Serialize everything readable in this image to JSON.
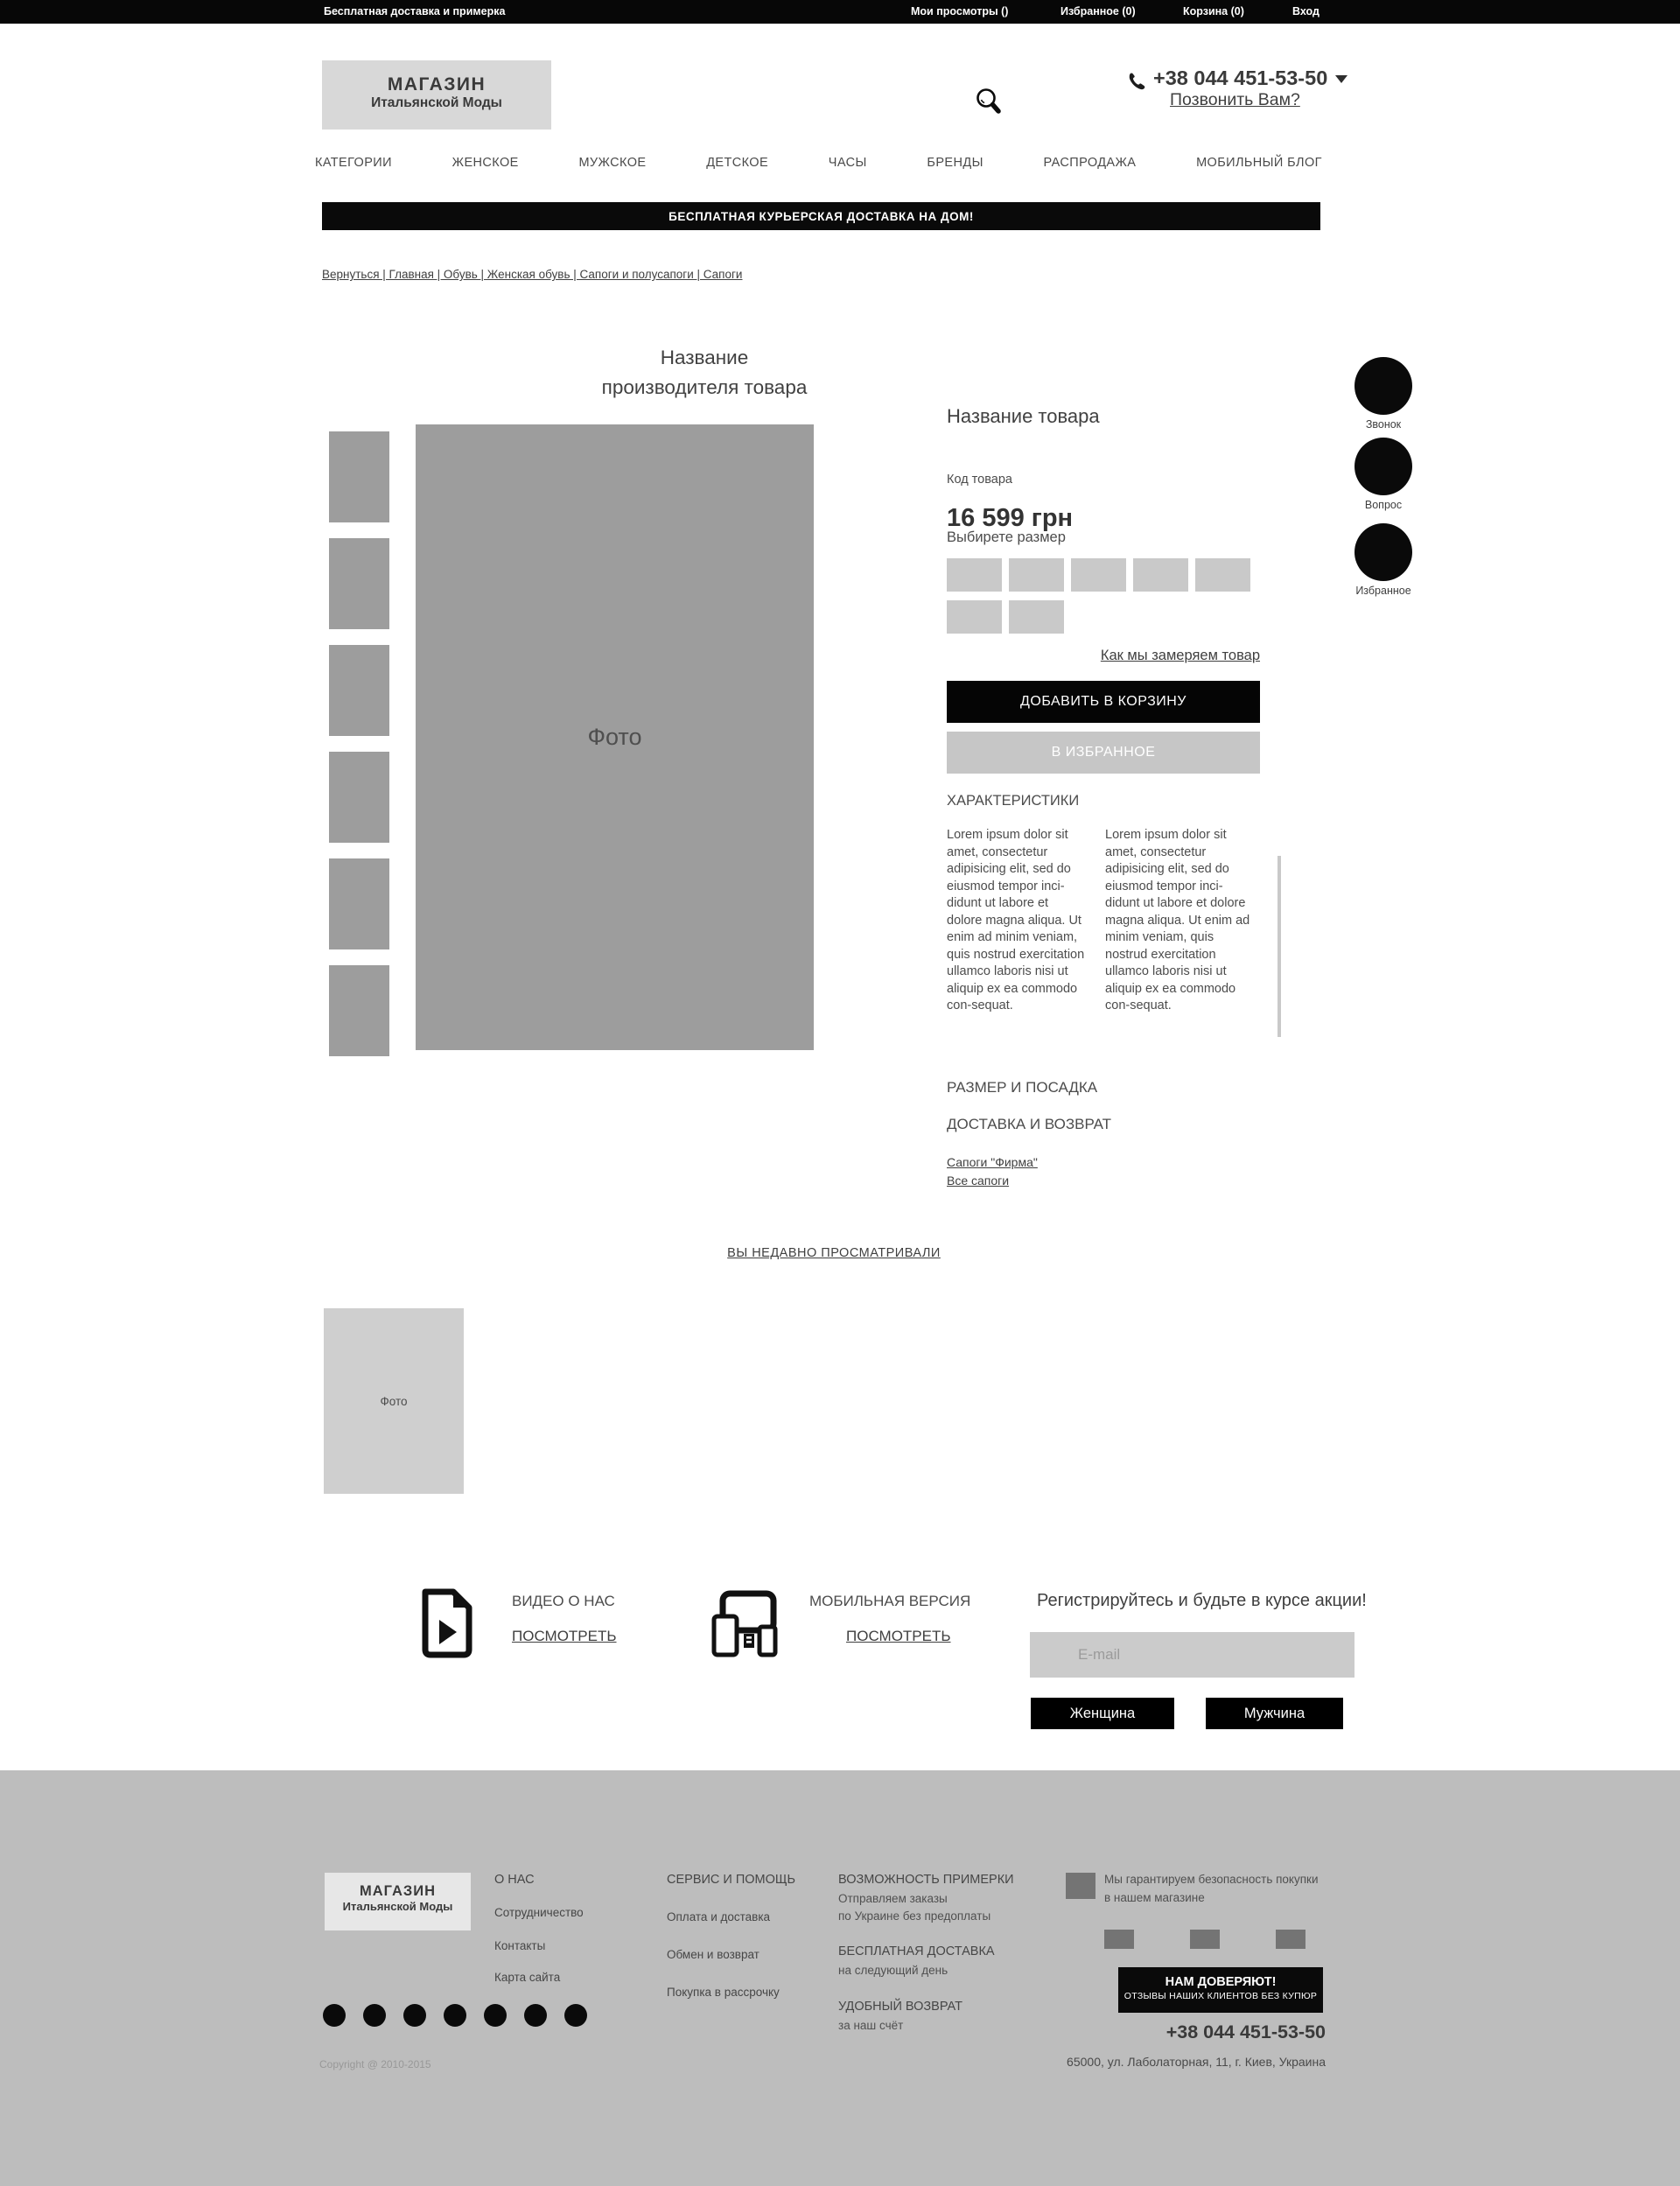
{
  "topbar": {
    "promo": "Бесплатная доставка и примерка",
    "views": "Мои просмотры ()",
    "favorites": "Избранное (0)",
    "cart": "Корзина (0)",
    "login": "Вход"
  },
  "header": {
    "logo_line1": "МАГАЗИН",
    "logo_line2": "Итальянской Моды",
    "phone": "+38 044 451-53-50",
    "call_link": "Позвонить Вам?"
  },
  "nav": {
    "items": [
      "КАТЕГОРИИ",
      "ЖЕНСКОЕ",
      "МУЖСКОЕ",
      "ДЕТСКОЕ",
      "ЧАСЫ",
      "БРЕНДЫ",
      "РАСПРОДАЖА",
      "МОБИЛЬНЫЙ БЛОГ"
    ]
  },
  "banner": "БЕСПЛАТНАЯ КУРЬЕРСКАЯ ДОСТАВКА НА ДОМ!",
  "breadcrumb": "Вернуться | Главная | Обувь | Женская  обувь | Сапоги и полусапоги | Сапоги",
  "product": {
    "brand_title": "Название производителя товара",
    "photo_label": "Фото",
    "name": "Название товара",
    "code_label": "Код товара",
    "price": "16 599 грн",
    "size_label": "Выбирете размер",
    "measure_link": "Как мы замеряем товар",
    "add_to_cart": "ДОБАВИТЬ В КОРЗИНУ",
    "add_to_favorites": "В ИЗБРАННОЕ",
    "specs_title": "ХАРАКТЕРИСТИКИ",
    "specs_text": "Lorem ipsum dolor sit amet, consectetur adipisicing elit, sed do eiusmod tempor inci-didunt ut labore et dolore magna aliqua. Ut enim ad minim veniam, quis nostrud exercitation ullamco laboris nisi ut aliquip ex ea commodo con-sequat.",
    "link_size_fit": "РАЗМЕР И ПОСАДКА",
    "link_delivery": "ДОСТАВКА И ВОЗВРАТ",
    "link_brand_boots": "Сапоги \"Фирма\"",
    "link_all_boots": "Все сапоги"
  },
  "side_buttons": {
    "call": "Звонок",
    "question": "Вопрос",
    "favorite": "Избранное"
  },
  "recently": {
    "title": "ВЫ НЕДАВНО ПРОСМАТРИВАЛИ",
    "photo_label": "Фото"
  },
  "promo": {
    "video_title": "ВИДЕО О НАС",
    "video_link": "ПОСМОТРЕТЬ",
    "mobile_title": "МОБИЛЬНАЯ ВЕРСИЯ",
    "mobile_link": "ПОСМОТРЕТЬ",
    "signup_title": "Регистрируйтесь и будьте в курсе акции!",
    "email_placeholder": "E-mail",
    "btn_female": "Женщина",
    "btn_male": "Мужчина"
  },
  "footer": {
    "logo_line1": "МАГАЗИН",
    "logo_line2": "Итальянской Моды",
    "about": {
      "head": "О НАС",
      "item1": "Сотрудничество",
      "item2": "Контакты",
      "item3": "Карта сайта"
    },
    "service": {
      "head": "СЕРВИС И ПОМОЩЬ",
      "item1": "Оплата и доставка",
      "item2": "Обмен и возврат",
      "item3": "Покупка в рассрочку"
    },
    "features": {
      "f1_head": "ВОЗМОЖНОСТЬ ПРИМЕРКИ",
      "f1_line1": "Отправляем заказы",
      "f1_line2": "по Украине без предоплаты",
      "f2_head": "БЕСПЛАТНАЯ ДОСТАВКА",
      "f2_line1": "на следующий день",
      "f3_head": "УДОБНЫЙ ВОЗВРАТ",
      "f3_line1": "за наш счёт"
    },
    "guarantee_line1": "Мы гарантируем безопасность покупки",
    "guarantee_line2": "в нашем магазине",
    "trust_line1": "НАМ ДОВЕРЯЮТ!",
    "trust_line2": "ОТЗЫВЫ НАШИХ КЛИЕНТОВ БЕЗ КУПЮР",
    "phone": "+38 044 451-53-50",
    "copyright": "Copyright @ 2010-2015",
    "address": "65000, ул. Лаболаторная, 11, г. Киев, Украина"
  },
  "colors": {
    "accent_black": "#0a0a0a",
    "photo_gray": "#9d9d9d",
    "light_gray": "#c9c9c9",
    "footer_gray": "#bdbdbd"
  }
}
